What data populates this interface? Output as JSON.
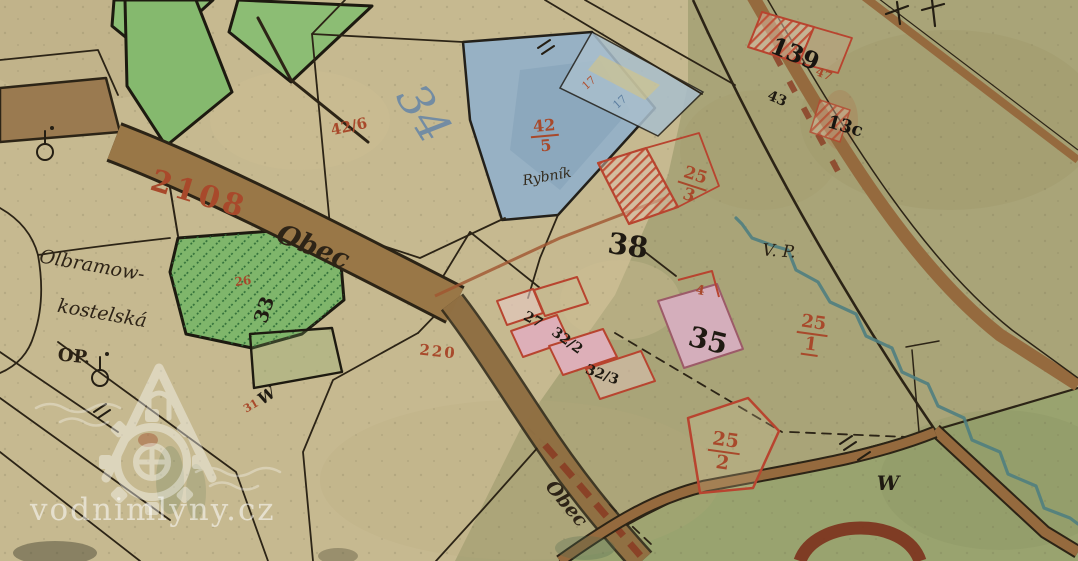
{
  "palette": {
    "paper_tan": "#c6b990",
    "paper_olive": "#a9a478",
    "meadow_green": "#8cbd74",
    "pond_blue": "#97b1c4",
    "road_brown": "#997747",
    "ink_black": "#241e13",
    "ink_red": "#a8492b",
    "stream_teal": "#4f7e80",
    "building_pink": "#ddafb8",
    "watermark_white": "#ffffff"
  },
  "watermark": {
    "site": "vodnimlyny.cz",
    "icon": "watermill-house-with-waterwheel-and-waves"
  },
  "map": {
    "labels": {
      "road_2108": {
        "text": "2108",
        "color": "#a8492b"
      },
      "road_obec_upper": {
        "text": "Obec",
        "color": "#2e2417"
      },
      "road_obec_lower": {
        "text": "Obec",
        "color": "#2e2417"
      },
      "parcel_42_6": {
        "text": "42/6",
        "color": "#a8492b"
      },
      "parcel_34": {
        "text": "34",
        "color": "#5f82a8"
      },
      "pond_name": {
        "text": "Rybník",
        "color": "#332a1c"
      },
      "frac_42_5_num": {
        "text": "42",
        "color": "#a8492b"
      },
      "frac_42_5_den": {
        "text": "5",
        "color": "#a8492b"
      },
      "tick_17_red": {
        "text": "17",
        "color": "#b0502f"
      },
      "tick_17_blue": {
        "text": "17",
        "color": "#5c7ea0"
      },
      "frac_25_3_num": {
        "text": "25",
        "color": "#a8492b"
      },
      "frac_25_3_den": {
        "text": "3",
        "color": "#a8492b"
      },
      "parcel_38": {
        "text": "38",
        "color": "#1f1a12"
      },
      "abbrev_vp": {
        "text": "V. P.",
        "color": "#2b2214"
      },
      "parcel_139": {
        "text": "139",
        "color": "#181510"
      },
      "parcel_43": {
        "text": "43",
        "color": "#1f1a12"
      },
      "parcel_47": {
        "text": "47",
        "color": "#a8492b"
      },
      "parcel_13c": {
        "text": "13c",
        "color": "#181510"
      },
      "frac_25_1_num": {
        "text": "25",
        "color": "#a8492b"
      },
      "frac_25_1_den": {
        "text": "1",
        "color": "#a8492b"
      },
      "parcel_35": {
        "text": "35",
        "color": "#1f1a12"
      },
      "parcel_27": {
        "text": "27",
        "color": "#1f1a12"
      },
      "parcel_32_2": {
        "text": "32/2",
        "color": "#1f1a12"
      },
      "parcel_32_3": {
        "text": "32/3",
        "color": "#1f1a12"
      },
      "frac_25_2_num": {
        "text": "25",
        "color": "#a8492b"
      },
      "frac_25_2_den": {
        "text": "2",
        "color": "#a8492b"
      },
      "parcel_220": {
        "text": "220",
        "color": "#a8492b"
      },
      "parcel_26": {
        "text": "26",
        "color": "#a8492b"
      },
      "parcel_33": {
        "text": "33",
        "color": "#1f1a12"
      },
      "parcel_31": {
        "text": "31",
        "color": "#a8492b"
      },
      "parcel_4": {
        "text": "4",
        "color": "#a8492b"
      },
      "meadow_w_left": {
        "text": "W",
        "color": "#1f1a12"
      },
      "meadow_w_right": {
        "text": "W",
        "color": "#1f1a12"
      },
      "road_olbramo_1": {
        "text": "Olbramow-",
        "color": "#2e2417"
      },
      "road_olbramo_2": {
        "text": "kostelská",
        "color": "#2e2417"
      },
      "abbrev_op": {
        "text": "OP.",
        "color": "#2b2214"
      }
    }
  }
}
